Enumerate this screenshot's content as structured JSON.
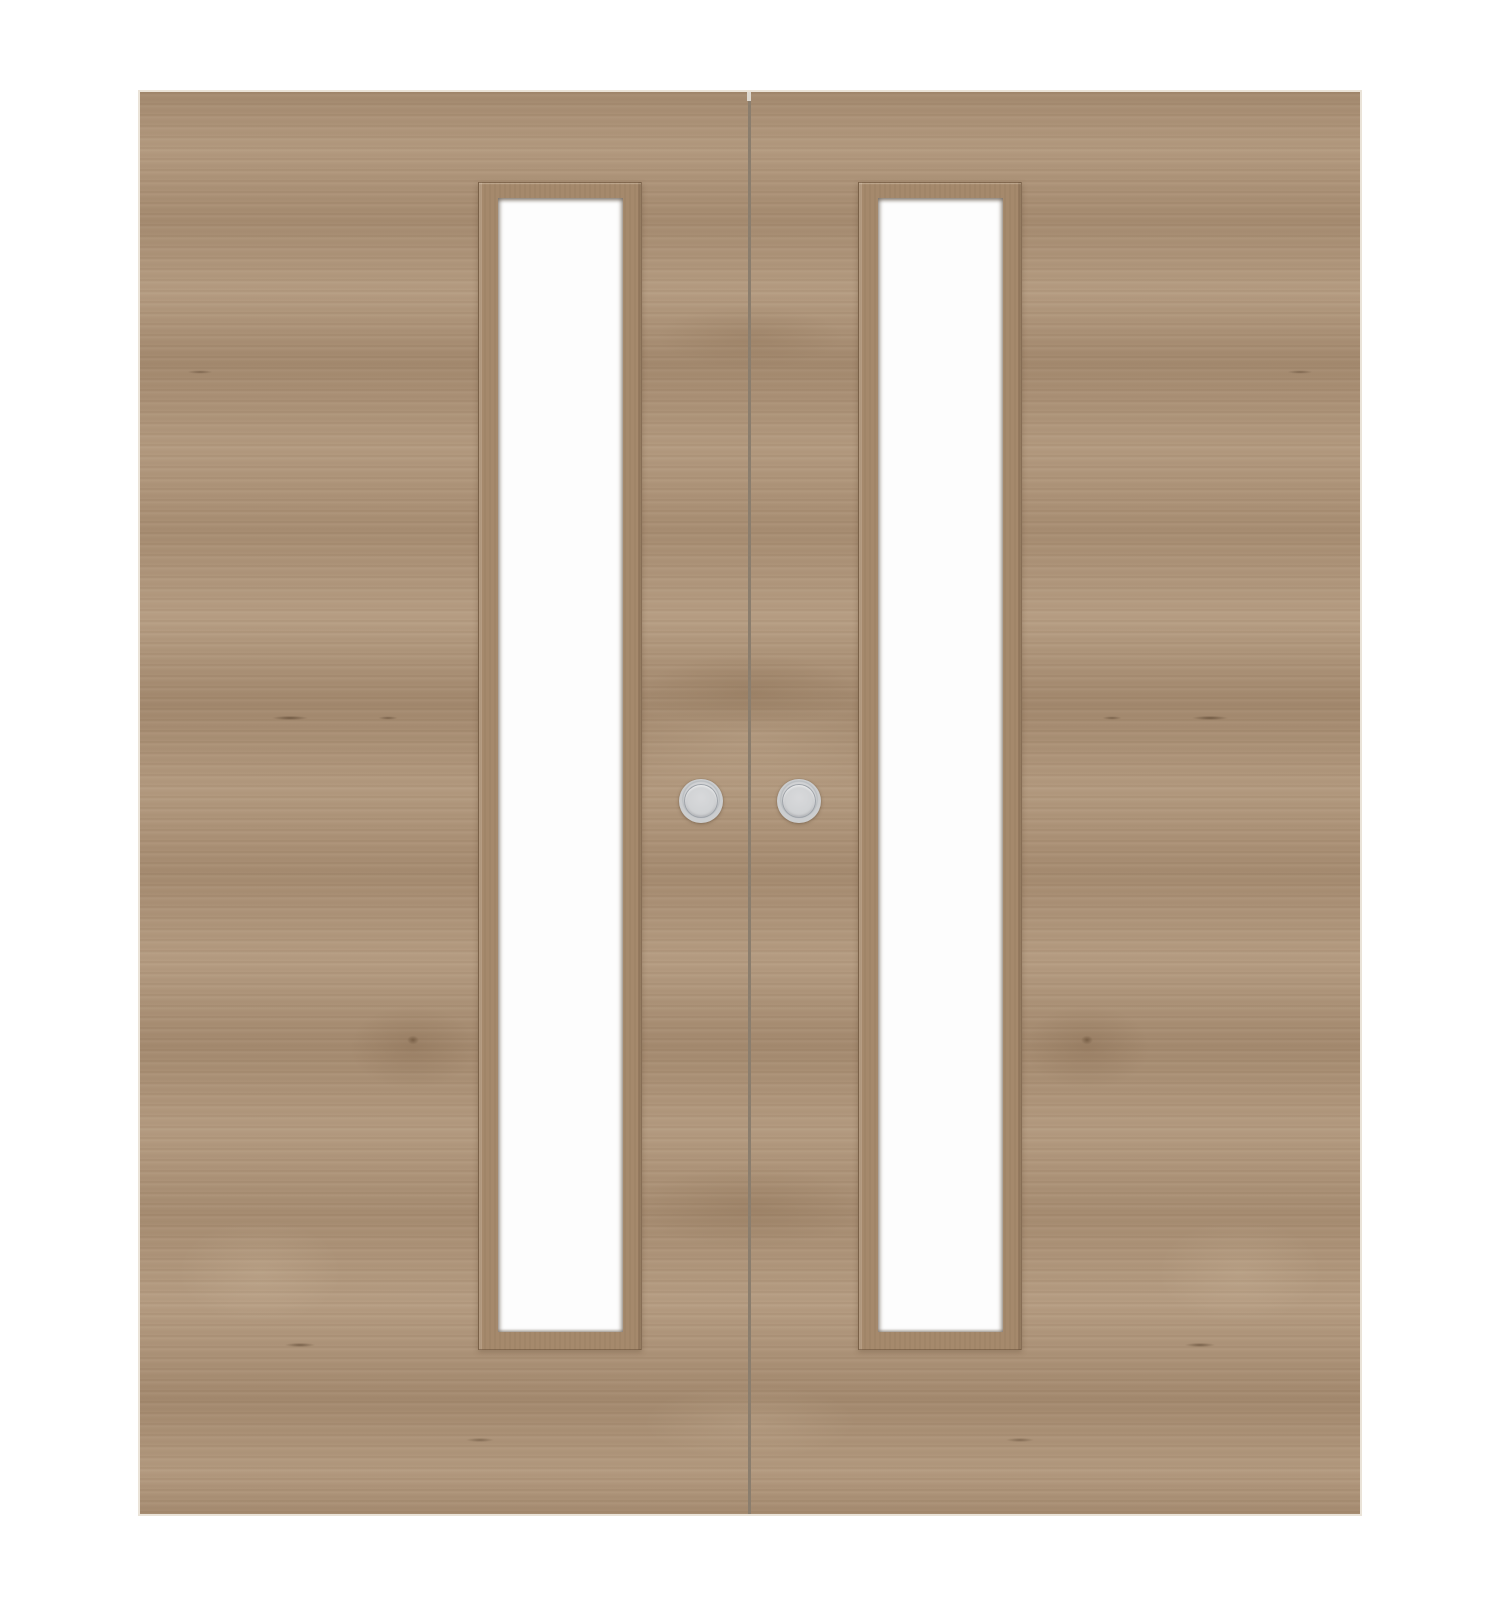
{
  "scene": {
    "description": "Product image of a pair of wooden internal double doors, each with a tall narrow vertical glazed vision panel and a round metal flush pull handle at the meeting edge",
    "background_color": "#ffffff"
  },
  "doors": {
    "count": 2,
    "finish": "light oak woodgrain, horizontally grained, mirror-matched across the meeting gap",
    "wood_base_color": "#ad9378",
    "wood_dark_grain_color": "#8e7257",
    "wood_light_grain_color": "#bda58a",
    "edge_highlight_color": "#eae3d8",
    "gap_color": "#8b7e6e",
    "gap_notch_color": "#ddd8d0"
  },
  "glazing": {
    "panels_count": 2,
    "shape": "tall narrow vertical rectangle with wooden bead frame",
    "glass_color": "#fdfdfd",
    "frame_color": "#a5896c",
    "frame_shadow_color": "#6c543c"
  },
  "handles": {
    "count": 2,
    "type": "round flush pull",
    "ring_color": "#c9cacc",
    "face_color": "#d4d5d7",
    "recess_line_color": "#8c9298"
  }
}
